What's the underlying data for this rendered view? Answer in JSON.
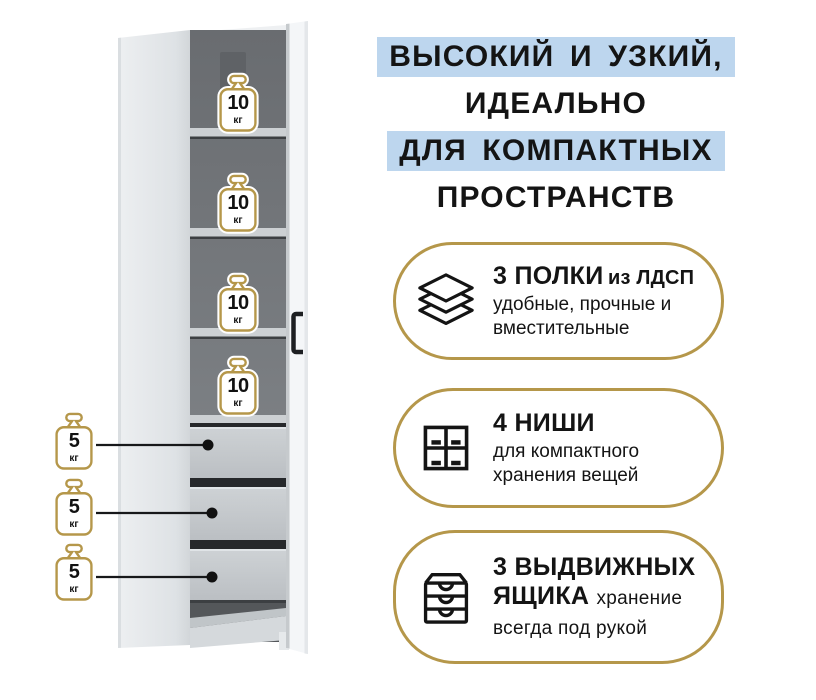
{
  "headline": {
    "line1": "ВЫСОКИЙ И УЗКИЙ,",
    "line2": "ИДЕАЛЬНО",
    "line3": "ДЛЯ КОМПАКТНЫХ",
    "line4": "ПРОСТРАНСТВ",
    "highlight_color": "#bdd6ee",
    "text_color": "#141414"
  },
  "features": {
    "accent_border_color": "#b5974a",
    "item1": {
      "icon": "layers-shelves-icon",
      "title": "3 ПОЛКИ",
      "title_note": "из ЛДСП",
      "description": "удобные, прочные и вместительные"
    },
    "item2": {
      "icon": "niches-grid-icon",
      "title": "4 НИШИ",
      "description": "для компактного хранения вещей"
    },
    "item3": {
      "icon": "drawer-chest-icon",
      "title": "3 ВЫДВИЖНЫХ ЯЩИКА",
      "description": "хранение всегда под рукой"
    }
  },
  "cabinet": {
    "weight_icon_color": "#b5974a",
    "shelf_loads": [
      {
        "value": "10",
        "unit": "кг"
      },
      {
        "value": "10",
        "unit": "кг"
      },
      {
        "value": "10",
        "unit": "кг"
      },
      {
        "value": "10",
        "unit": "кг"
      }
    ],
    "drawer_loads": [
      {
        "value": "5",
        "unit": "кг"
      },
      {
        "value": "5",
        "unit": "кг"
      },
      {
        "value": "5",
        "unit": "кг"
      }
    ]
  }
}
